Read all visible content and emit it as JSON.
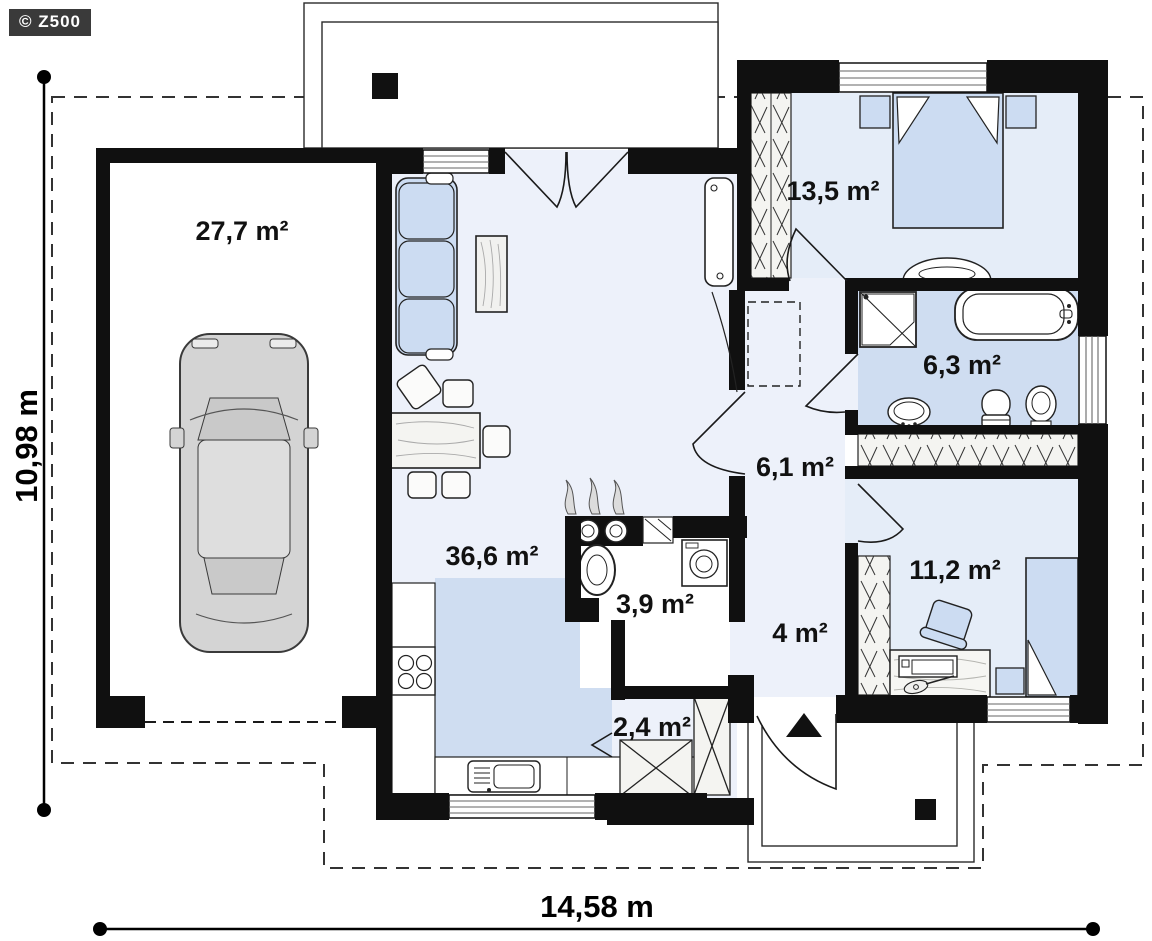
{
  "brand": "© Z500",
  "rooms": [
    {
      "name": "garage",
      "area": "27,7 m²"
    },
    {
      "name": "living-kitchen",
      "area": "36,6 m²"
    },
    {
      "name": "bedroom",
      "area": "13,5 m²"
    },
    {
      "name": "bathroom",
      "area": "6,3 m²"
    },
    {
      "name": "hall",
      "area": "6,1 m²"
    },
    {
      "name": "utility",
      "area": "3,9 m²"
    },
    {
      "name": "entry",
      "area": "4 m²"
    },
    {
      "name": "bedroom-2",
      "area": "11,2 m²"
    },
    {
      "name": "storage",
      "area": "2,4 m²"
    }
  ],
  "dimensions": {
    "width": "14,58 m",
    "height": "10,98 m"
  },
  "colors": {
    "wall": "#101010",
    "floor_light": "#edf1fa",
    "floor_tint": "#e5edf8",
    "floor_blue": "#cfddf1",
    "floor_white": "#ffffff",
    "furniture_blue": "#ccdcf2",
    "car_body": "#d4d4d4",
    "line": "#1a1a1a"
  }
}
